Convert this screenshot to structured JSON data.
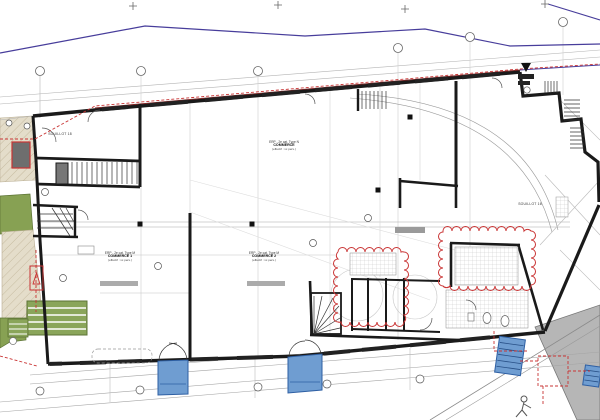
{
  "document": {
    "type": "architectural ground-floor plan",
    "background": "#ffffff"
  },
  "labels": {
    "parcel_left": "SOUILLOT 18",
    "parcel_right": "SOUILLOT 16",
    "unit_top": {
      "line1": "ERP - 2e cat. Type N",
      "line2": "COMMERCE",
      "line3": "(effectif : xx pers.)"
    },
    "unit_left": {
      "line1": "ERP - 2e cat. Type M",
      "line2": "COMMERCE 1",
      "line3": "(effectif : xx pers.)"
    },
    "unit_mid": {
      "line1": "ERP - 2e cat. Type M",
      "line2": "COMMERCE 2",
      "line3": "(effectif : xx pers.)"
    }
  },
  "icons": {
    "person-icon": "stick figure pedestrian",
    "north-triangle-icon": "black triangle marker"
  },
  "colors": {
    "wall": "#1a1a1a",
    "site_boundary_purple": "#473d9b",
    "revision_red": "#c93434",
    "facade_line_maroon": "#7a2525",
    "landscape_green": "#87a153",
    "paving_beige": "#e4ddca",
    "entrance_blue": "#6f9dd1",
    "entrance_blue_dark": "#2e5fa3",
    "neighbor_gray": "#b6b6b6"
  }
}
